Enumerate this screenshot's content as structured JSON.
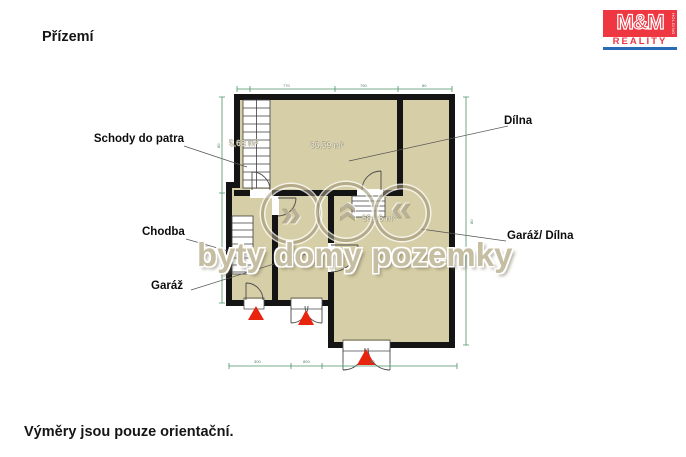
{
  "title": "Přízemí",
  "footer": "Výměry jsou pouze orientační.",
  "logo": {
    "top": "M&M",
    "holding": "HOLDING",
    "bottom": "REALITY"
  },
  "watermark": {
    "text": "byty domy pozemky",
    "glyph1": "»",
    "glyph2": "»",
    "glyph3": "»"
  },
  "rooms": {
    "schody": {
      "label": "Schody do patra",
      "area": "5,68 m²"
    },
    "dilna": {
      "label": "Dílna",
      "area": "35,59 m²"
    },
    "chodba": {
      "label": "Chodba"
    },
    "garaz": {
      "label": "Garáž"
    },
    "garaz_dilna": {
      "label": "Garáž/ Dílna",
      "area": "68,96 m²"
    }
  },
  "dimensions": {
    "top": [
      "770",
      "790",
      "80"
    ],
    "bottom": [
      "300",
      "800",
      "80"
    ],
    "left": [
      "80"
    ],
    "right": [
      "80"
    ]
  },
  "colors": {
    "floor": "#d6cea6",
    "wall": "#141414",
    "dimension_line": "#4d9166",
    "entrance_triangle": "#e8240f",
    "watermark": "#c6bea2",
    "logo_red": "#ee3741",
    "logo_blue": "#2a6bb5"
  }
}
